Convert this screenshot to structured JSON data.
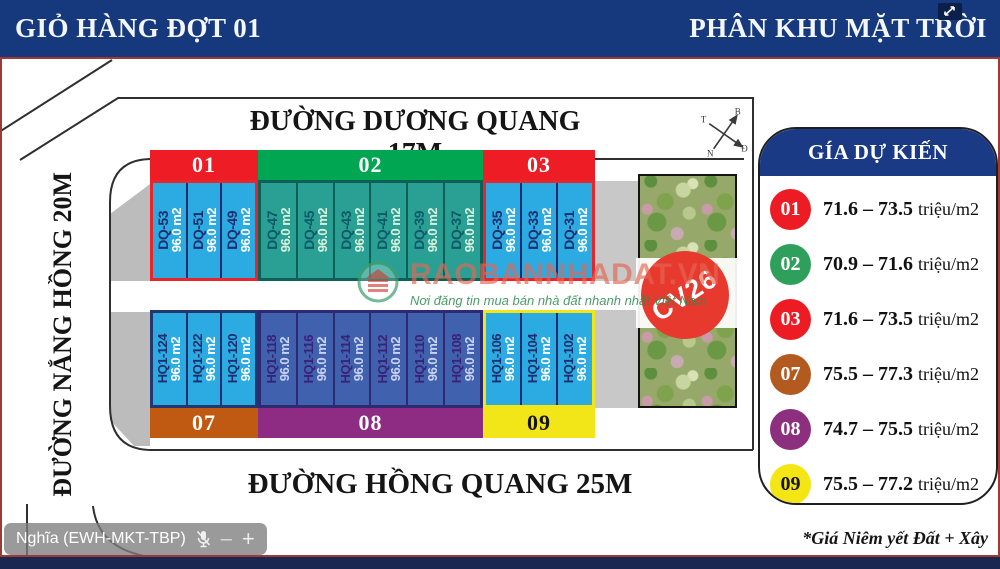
{
  "header": {
    "left_title": "GIỎ HÀNG ĐỢT 01",
    "right_title": "PHÂN KHU MẶT TRỜI",
    "bar_color": "#16397d"
  },
  "streets": {
    "top": "ĐƯỜNG DƯƠNG QUANG 17M",
    "left": "ĐƯỜNG NẮNG HỒNG 20M",
    "bottom": "ĐƯỜNG HỒNG QUANG 25M"
  },
  "compass": {
    "north": "B",
    "east": "Đ",
    "south": "N",
    "west": "T"
  },
  "park": {
    "label": "CV26",
    "circle_color": "#e8392e"
  },
  "blocks": [
    {
      "id": "01",
      "header_color": "#ee1c25",
      "plot_fill": "#2caae2",
      "plots": [
        {
          "id": "DQ-53",
          "area": "96.0 m2"
        },
        {
          "id": "DQ-51",
          "area": "96.0 m2"
        },
        {
          "id": "DQ-49",
          "area": "96.0 m2"
        }
      ]
    },
    {
      "id": "02",
      "header_color": "#00a651",
      "plot_fill": "#2aa095",
      "plots": [
        {
          "id": "DQ-47",
          "area": "96.0 m2"
        },
        {
          "id": "DQ-45",
          "area": "96.0 m2"
        },
        {
          "id": "DQ-43",
          "area": "96.0 m2"
        },
        {
          "id": "DQ-41",
          "area": "96.0 m2"
        },
        {
          "id": "DQ-39",
          "area": "96.0 m2"
        },
        {
          "id": "DQ-37",
          "area": "96.0 m2"
        }
      ]
    },
    {
      "id": "03",
      "header_color": "#ee1c25",
      "plot_fill": "#2caae2",
      "plots": [
        {
          "id": "DQ-35",
          "area": "96.0 m2"
        },
        {
          "id": "DQ-33",
          "area": "96.0 m2"
        },
        {
          "id": "DQ-31",
          "area": "96.0 m2"
        }
      ]
    },
    {
      "id": "07",
      "header_color": "#c05a12",
      "plot_fill": "#2caae2",
      "plots": [
        {
          "id": "HQ1-124",
          "area": "96.0 m2"
        },
        {
          "id": "HQ1-122",
          "area": "96.0 m2"
        },
        {
          "id": "HQ1-120",
          "area": "96.0 m2"
        }
      ]
    },
    {
      "id": "08",
      "header_color": "#8e2c83",
      "plot_fill": "#4062ae",
      "plots": [
        {
          "id": "HQ1-118",
          "area": "96.0 m2"
        },
        {
          "id": "HQ1-116",
          "area": "96.0 m2"
        },
        {
          "id": "HQ1-114",
          "area": "96.0 m2"
        },
        {
          "id": "HQ1-112",
          "area": "96.0 m2"
        },
        {
          "id": "HQ1-110",
          "area": "96.0 m2"
        },
        {
          "id": "HQ1-108",
          "area": "96.0 m2"
        }
      ]
    },
    {
      "id": "09",
      "header_color": "#f2e619",
      "plot_fill": "#2caae2",
      "plots": [
        {
          "id": "HQ1-106",
          "area": "96.0 m2"
        },
        {
          "id": "HQ1-104",
          "area": "96.0 m2"
        },
        {
          "id": "HQ1-102",
          "area": "96.0 m2"
        }
      ]
    }
  ],
  "legend": {
    "title": "GÍA DỰ KIẾN",
    "entries": [
      {
        "id": "01",
        "color": "#ed1c24",
        "price_range": "71.6 – 73.5",
        "unit": "triệu/m2"
      },
      {
        "id": "02",
        "color": "#2fa05c",
        "price_range": "70.9 – 71.6",
        "unit": "triệu/m2"
      },
      {
        "id": "03",
        "color": "#ed1c24",
        "price_range": "71.6 – 73.5",
        "unit": "triệu/m2"
      },
      {
        "id": "07",
        "color": "#b25a20",
        "price_range": "75.5 – 77.3",
        "unit": "triệu/m2"
      },
      {
        "id": "08",
        "color": "#8b2f7e",
        "price_range": "74.7 – 75.5",
        "unit": "triệu/m2"
      },
      {
        "id": "09",
        "color": "#f4e615",
        "price_range": "75.5 – 77.2",
        "unit": "triệu/m2"
      }
    ],
    "note": "*Giá Niêm yết Đất + Xây"
  },
  "watermark": {
    "brand": "RAOBANNHADAT.VN",
    "tagline": "Nơi đăng tin mua bán nhà đất nhanh nhất Việt Nam"
  },
  "meeting_overlay": {
    "participant": "Nghĩa (EWH-MKT-TBP)"
  },
  "icons": {
    "minus": "–",
    "plus": "+"
  }
}
